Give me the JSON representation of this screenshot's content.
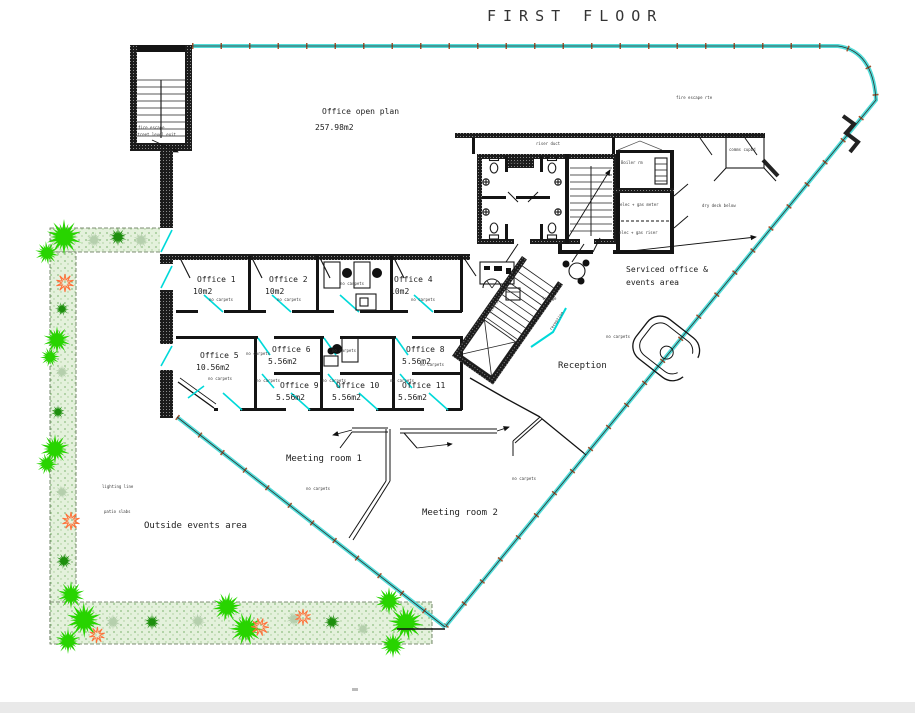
{
  "title": "FIRST FLOOR",
  "rooms": {
    "open_plan": {
      "label": "Office open plan",
      "area": "257.98m2"
    },
    "offices": [
      {
        "label": "Office 1",
        "area": "10m2"
      },
      {
        "label": "Office 2",
        "area": "10m2"
      },
      {
        "label": "Office 4",
        "area": "10m2"
      },
      {
        "label": "Office 5",
        "area": "10.56m2"
      },
      {
        "label": "Office 6",
        "area": "5.56m2"
      },
      {
        "label": "Office 8",
        "area": "5.56m2"
      },
      {
        "label": "Office 9",
        "area": "5.56m2"
      },
      {
        "label": "Office 10",
        "area": "5.56m2"
      },
      {
        "label": "Office 11",
        "area": "5.56m2"
      }
    ],
    "serviced_office": {
      "line1": "Serviced office &",
      "line2": "events area"
    },
    "reception": "Reception",
    "meeting_room_1": "Meeting room 1",
    "meeting_room_2": "Meeting room 2",
    "outside": "Outside events area"
  },
  "annotations": {
    "stair_note_1": "fire escape",
    "stair_note_2": "street level exit",
    "roof_note": "fire escape rte",
    "riser": "riser duct",
    "boiler": "Boiler rm",
    "comms": "comms cupbd",
    "plant_room_1": "elec + gas meter",
    "plant_room_2": "elec + gas riser",
    "dry_deck": "dry deck below",
    "basins": "basins",
    "lounge": "lounge",
    "stairs": "stairs",
    "reception_small": "reception",
    "no_carpets": "no carpets",
    "lighting": "lighting line",
    "patio": "patio slabs"
  },
  "colors": {
    "glazing": "#52dcd8",
    "window": "#00d9d9",
    "wall": "#141414",
    "tree": "#28d400",
    "bush": "#1e8f0e",
    "shrub": "#b5cfad",
    "flower": "#ff7038",
    "tick": "#a0522d"
  }
}
